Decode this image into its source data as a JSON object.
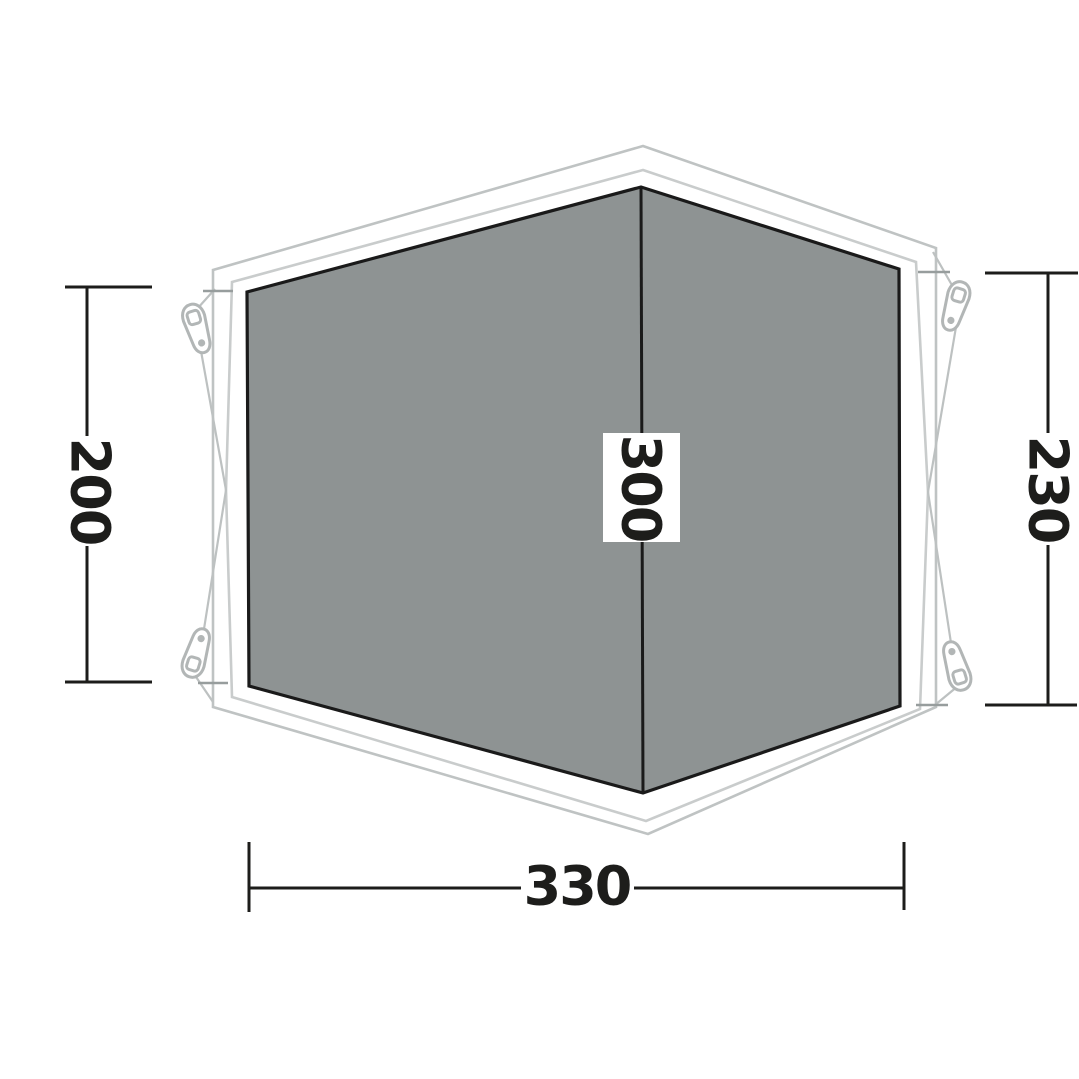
{
  "diagram": {
    "kind": "tent-footprint-dimension-diagram",
    "dimensions": {
      "left_height": "200",
      "right_height": "230",
      "center_depth": "300",
      "bottom_width": "330"
    },
    "colors": {
      "background": "#ffffff",
      "groundsheet_fill": "#8e9393",
      "groundsheet_outline": "#1a1a1a",
      "flysheet_outline_outer": "#bfc3c3",
      "flysheet_outline_inner": "#c9cccc",
      "guy_line": "#bdc1c1",
      "peg_tab": "#b2b6b6",
      "dimension_ink": "#1d1d1b",
      "extension_line": "#979d9d",
      "center_label_background": "#ffffff"
    }
  }
}
